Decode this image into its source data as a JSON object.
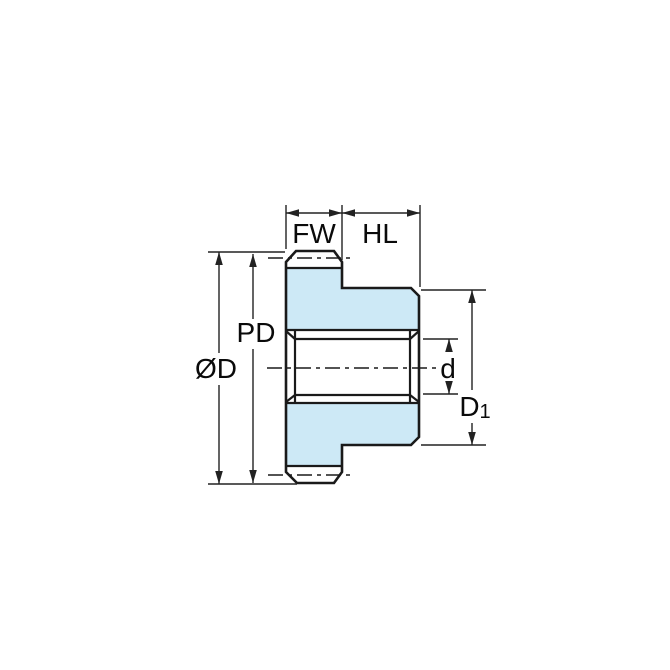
{
  "diagram": {
    "kind": "spur-gear-cross-section-technical-drawing",
    "labels": {
      "face_width": "FW",
      "hub_length": "HL",
      "pitch_diameter": "PD",
      "outside_diameter": "ØD",
      "bore_diameter": "d",
      "hub_diameter": "D",
      "hub_diameter_sub": "1"
    },
    "colors": {
      "part_fill": "#CDE9F6",
      "line": "#1A1A1A",
      "dimension": "#222222",
      "background": "#FFFFFF"
    }
  }
}
